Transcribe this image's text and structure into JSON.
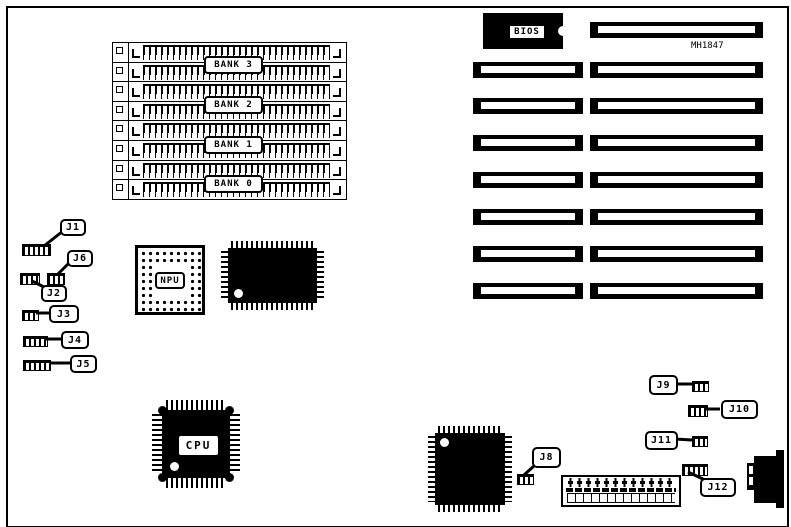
{
  "board": {
    "model": "MH1847",
    "bios": {
      "label": "BIOS"
    },
    "cpu": {
      "label": "CPU"
    },
    "npu": {
      "label": "NPU"
    },
    "memory": {
      "banks": [
        "BANK 3",
        "BANK 2",
        "BANK 1",
        "BANK 0"
      ]
    },
    "jumpers": [
      {
        "id": "J1"
      },
      {
        "id": "J2"
      },
      {
        "id": "J3"
      },
      {
        "id": "J4"
      },
      {
        "id": "J5"
      },
      {
        "id": "J6"
      },
      {
        "id": "J8"
      },
      {
        "id": "J9"
      },
      {
        "id": "J10"
      },
      {
        "id": "J11"
      },
      {
        "id": "J12"
      }
    ],
    "colors": {
      "ink": "#000000",
      "background": "#ffffff"
    }
  }
}
